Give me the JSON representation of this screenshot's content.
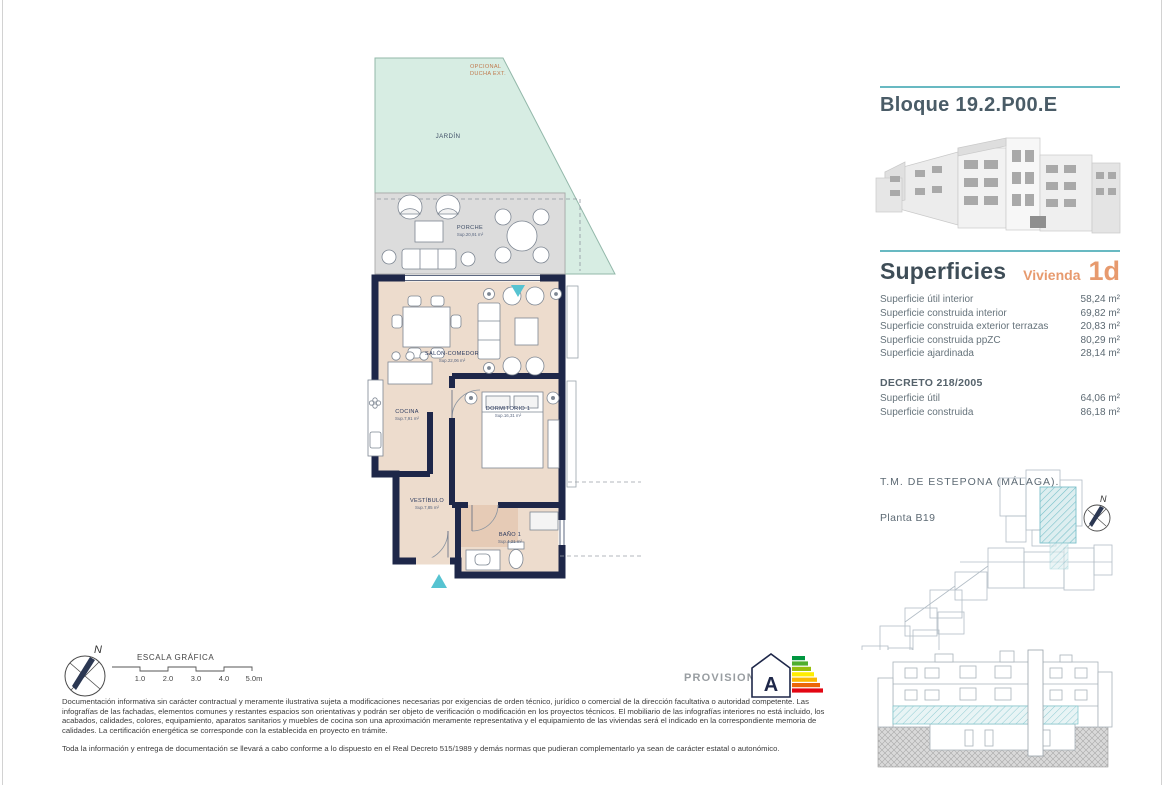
{
  "colors": {
    "accent_teal": "#68b9c2",
    "accent_orange": "#e79a6e",
    "wall_navy": "#1e2749",
    "floor_beige": "#eddccd",
    "garden_green": "#d7ede3",
    "porch_gray": "#dcdcdc"
  },
  "plan": {
    "garden_label": "JARDÍN",
    "optional_label_1": "OPCIONAL",
    "optional_label_2": "DUCHA EXT.",
    "rooms": [
      {
        "name": "PORCHE",
        "sup": "Sup.20,91 m²"
      },
      {
        "name": "SALÓN-COMEDOR",
        "sup": "Sup.22,06 m²"
      },
      {
        "name": "COCINA",
        "sup": "Sup.7,91 m²"
      },
      {
        "name": "DORMITORIO 1",
        "sup": "Sup.16,31 m²"
      },
      {
        "name": "VESTÍBULO",
        "sup": "Sup.7,85 m²"
      },
      {
        "name": "BAÑO 1",
        "sup": "Sup.4,21 m²"
      }
    ]
  },
  "sidebar": {
    "block_title": "Bloque 19.2.P00.E",
    "surfaces": {
      "title": "Superficies",
      "unit_label": "Vivienda",
      "unit_code": "1d",
      "rows": [
        {
          "label": "Superficie útil interior",
          "value": "58,24 m²"
        },
        {
          "label": "Superficie construida interior",
          "value": "69,82 m²"
        },
        {
          "label": "Superficie construida exterior terrazas",
          "value": "20,83 m²"
        },
        {
          "label": "Superficie construida ppZC",
          "value": "80,29 m²"
        },
        {
          "label": "Superficie ajardinada",
          "value": "28,14 m²"
        }
      ],
      "decree_title": "DECRETO 218/2005",
      "decree_rows": [
        {
          "label": "Superficie útil",
          "value": "64,06 m²"
        },
        {
          "label": "Superficie construida",
          "value": "86,18 m²"
        }
      ]
    },
    "location": {
      "municipality": "T.M. DE ESTEPONA (MÁLAGA).",
      "floor": "Planta B19",
      "compass_n": "N"
    }
  },
  "footer": {
    "compass_n": "N",
    "scale": {
      "title": "ESCALA GRÁFICA",
      "ticks": [
        "1.0",
        "2.0",
        "3.0",
        "4.0",
        "5.0m"
      ]
    },
    "provisional": "PROVISIONAL",
    "energy_rating": "A",
    "disclaimer_p1": "Documentación informativa sin carácter contractual y meramente ilustrativa sujeta a modificaciones necesarias por exigencias de orden técnico, jurídico o comercial de la dirección facultativa o autoridad competente. Las infografías de las fachadas, elementos comunes y restantes espacios son orientativas y podrán ser objeto de verificación o modificación en los proyectos técnicos. El mobiliario de las infografías interiores no está incluido, los acabados, calidades, colores, equipamiento, aparatos sanitarios y muebles de cocina son una aproximación meramente representativa y el equipamiento de las viviendas será el indicado en la correspondiente memoria de calidades. La certificación energética se corresponde con la establecida en proyecto en trámite.",
    "disclaimer_p2": "Toda la información y entrega de documentación se llevará a cabo conforme a lo dispuesto en el Real Decreto 515/1989 y demás normas que pudieran complementarlo ya sean de carácter estatal o autonómico."
  }
}
